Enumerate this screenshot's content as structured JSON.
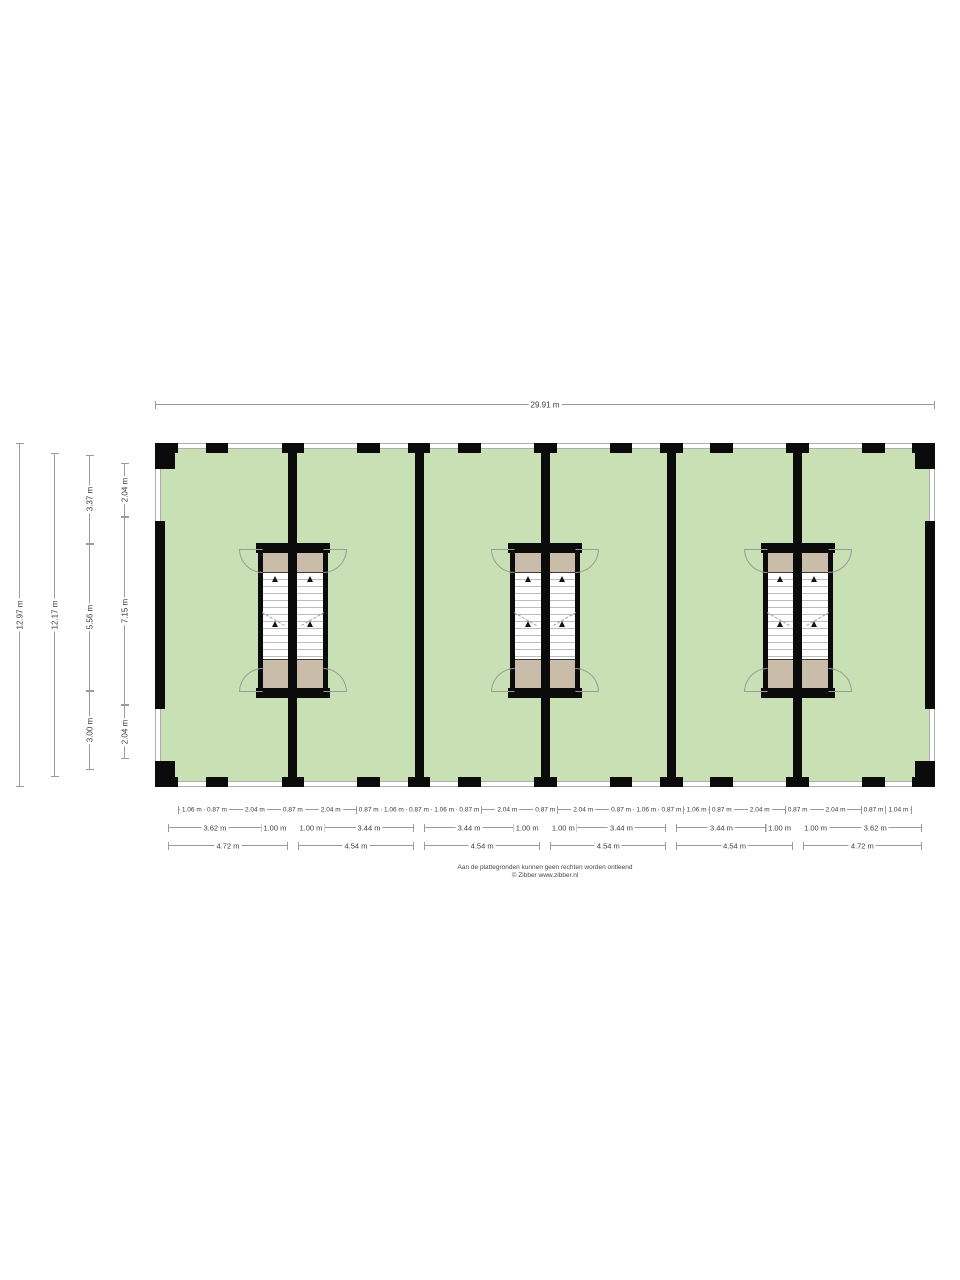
{
  "title": "Verdieping plattegrond",
  "colors": {
    "floor": "#c9e0b5",
    "wall": "#0b0b0b",
    "landing": "#c9bda9",
    "window_line": "#adadad",
    "stair_tread": "#bdbdbd",
    "door_arc": "#9a9a9a",
    "dim_line": "#9b9b9b",
    "dim_text": "#3a3a3a"
  },
  "dimensions": {
    "top": {
      "label": "29.91 m",
      "value": 29.91
    },
    "left_lines": [
      {
        "name": "overall-height",
        "segments": [
          {
            "label": "12.97 m",
            "value": 12.97
          }
        ]
      },
      {
        "name": "inner-height",
        "segments": [
          {
            "label": "12.17 m",
            "value": 12.17
          }
        ]
      },
      {
        "name": "room-split",
        "segments": [
          {
            "label": "3.37 m",
            "value": 3.37
          },
          {
            "label": "5.56 m",
            "value": 5.56
          },
          {
            "label": "3.00 m",
            "value": 3.0
          }
        ]
      },
      {
        "name": "window-split",
        "segments": [
          {
            "label": "2.04 m",
            "value": 2.04
          },
          {
            "label": "7.15 m",
            "value": 7.15
          },
          {
            "label": "2.04 m",
            "value": 2.04
          }
        ]
      }
    ],
    "bottom_row1": [
      {
        "label": "1.06 m",
        "value": 1.06
      },
      {
        "label": "0.87 m",
        "value": 0.87
      },
      {
        "label": "2.04 m",
        "value": 2.04
      },
      {
        "label": "0.87 m",
        "value": 0.87
      },
      {
        "label": "2.04 m",
        "value": 2.04
      },
      {
        "label": "0.87 m",
        "value": 0.87
      },
      {
        "label": "1.06 m",
        "value": 1.06
      },
      {
        "label": "0.87 m",
        "value": 0.87
      },
      {
        "label": "1.06 m",
        "value": 1.06
      },
      {
        "label": "0.87 m",
        "value": 0.87
      },
      {
        "label": "2.04 m",
        "value": 2.04
      },
      {
        "label": "0.87 m",
        "value": 0.87
      },
      {
        "label": "2.04 m",
        "value": 2.04
      },
      {
        "label": "0.87 m",
        "value": 0.87
      },
      {
        "label": "1.06 m",
        "value": 1.06
      },
      {
        "label": "0.87 m",
        "value": 0.87
      },
      {
        "label": "1.06 m",
        "value": 1.06
      },
      {
        "label": "0.87 m",
        "value": 0.87
      },
      {
        "label": "2.04 m",
        "value": 2.04
      },
      {
        "label": "0.87 m",
        "value": 0.87
      },
      {
        "label": "2.04 m",
        "value": 2.04
      },
      {
        "label": "0.87 m",
        "value": 0.87
      },
      {
        "label": "1.04 m",
        "value": 1.04
      }
    ],
    "bottom_row2_bays": [
      [
        {
          "label": "3.62 m",
          "value": 3.62
        },
        {
          "label": "1.00 m",
          "value": 1.0
        }
      ],
      [
        {
          "label": "1.00 m",
          "value": 1.0
        },
        {
          "label": "3.44 m",
          "value": 3.44
        }
      ],
      [
        {
          "label": "3.44 m",
          "value": 3.44
        },
        {
          "label": "1.00 m",
          "value": 1.0
        }
      ],
      [
        {
          "label": "1.00 m",
          "value": 1.0
        },
        {
          "label": "3.44 m",
          "value": 3.44
        }
      ],
      [
        {
          "label": "3.44 m",
          "value": 3.44
        },
        {
          "label": "1.00 m",
          "value": 1.0
        }
      ],
      [
        {
          "label": "1.00 m",
          "value": 1.0
        },
        {
          "label": "3.62 m",
          "value": 3.62
        }
      ]
    ],
    "bottom_row3": [
      {
        "label": "4.72 m",
        "value": 4.72
      },
      {
        "label": "4.54 m",
        "value": 4.54
      },
      {
        "label": "4.54 m",
        "value": 4.54
      },
      {
        "label": "4.54 m",
        "value": 4.54
      },
      {
        "label": "4.54 m",
        "value": 4.54
      },
      {
        "label": "4.72 m",
        "value": 4.72
      }
    ]
  },
  "footer": {
    "line1": "Aan de plattegronden kunnen geen rechten worden ontleend",
    "line2": "© Zibber www.zibber.nl"
  }
}
